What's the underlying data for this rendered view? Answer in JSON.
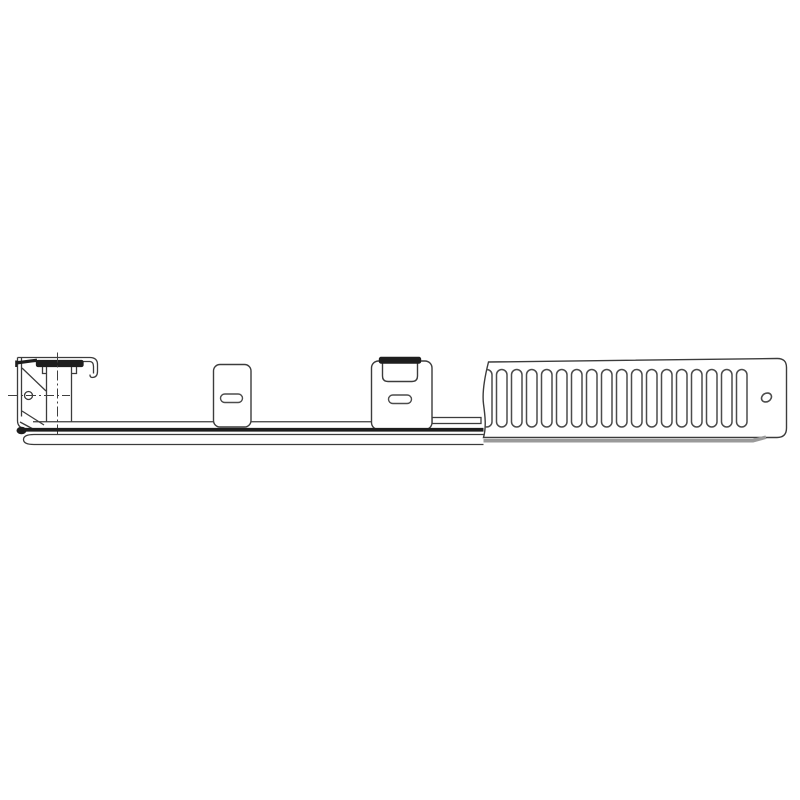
{
  "drawing": {
    "description": "technical-line-drawing-of-bracket-rail-assembly",
    "background": "#ffffff",
    "colors": {
      "line": "#3c3c3c",
      "line_heavy": "#1e1e1e",
      "slot": "#4c4c4c",
      "shadow": "#9a9a9a",
      "centerline": "#404040",
      "fill": "#ffffff"
    },
    "vent_panel": {
      "slot_count": 17,
      "include_partial_slot": true,
      "first_slot_x": 496.5,
      "slot_pitch": 15,
      "slot_width": 10.5,
      "slot_top": 369.5,
      "slot_bottom": 427,
      "hole": {
        "cx": 766.5,
        "cy": 397.5,
        "rx": 5.2,
        "ry": 4.2,
        "rotate": -30
      }
    },
    "bracket": {
      "hole": {
        "cx": 28.5,
        "cy": 395.5,
        "r": 4
      }
    }
  }
}
